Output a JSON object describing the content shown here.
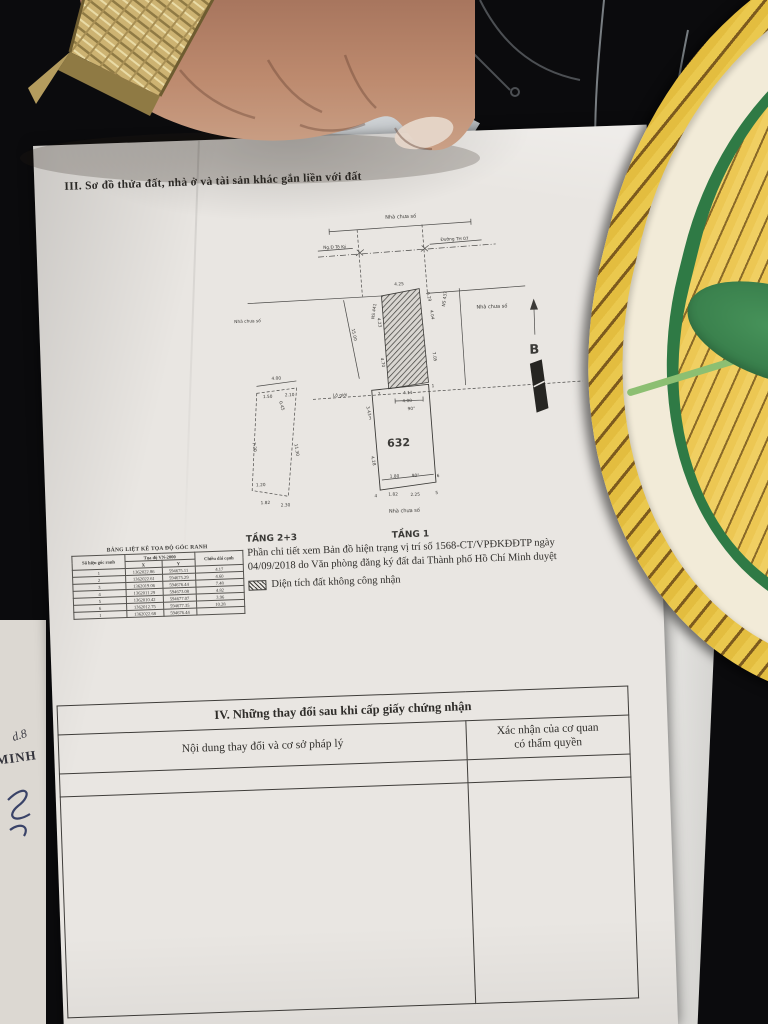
{
  "scene": {
    "background_color": "#0b0b0d",
    "paper_color": "#e9e6e2",
    "basket_yellow": "#eac84e",
    "basket_stripe": "#7c5a1e",
    "basket_rim": "#f2ebd8",
    "leaf_green": "#3e8a50",
    "hand_skin": "#b9856a",
    "watch_gold": "#cdb372",
    "carpet_gray": "#9b9995"
  },
  "document": {
    "section3_heading": "III. Sơ đồ thửa đất, nhà ở và tài sản khác gắn liền với đất",
    "diagram": {
      "labels": {
        "house_top": "Nhà chưa số",
        "street_left": "Ng.Đ Tô Ký",
        "street_right": "Đường TH 07",
        "house_left": "Nhà chưa số",
        "house_right": "Nhà chưa số",
        "house_bottom": "Nhà chưa số",
        "lo_gioi": "Lộ giới",
        "ns_left": "NS 441",
        "ns_right": "NS 437",
        "d15": "15.00",
        "north": "B",
        "plot_number": "632",
        "floor1": "TẦNG 1",
        "floors23": "TẦNG 2+3"
      },
      "dims": {
        "t1": "4.25",
        "t2": "0.29",
        "l1": "4.23",
        "r1": "4.04",
        "l2": "4.70",
        "r2": "7.05",
        "b1": "4.11",
        "b2": "4.00",
        "ang": "90°",
        "v1": "1",
        "v2": "2",
        "v3": "3",
        "v4": "4",
        "v5": "5",
        "v6": "6",
        "pl1": "3.43",
        "pl2": "4.28",
        "pb1": "1.82",
        "pb2": "2.25",
        "pb3": "1.80",
        "pang": "90°"
      },
      "annex_dims": {
        "t": "4.00",
        "s1": "1.50",
        "s2": "0.45",
        "s3": "2.10",
        "l": "7.20",
        "r": "11.30",
        "b1": "1.82",
        "b2": "2.30",
        "b3": "1.20"
      }
    },
    "coords_table": {
      "title": "BẢNG LIỆT KÊ TỌA ĐỘ GÓC RANH",
      "col_corner": "Số hiệu góc ranh",
      "col_group": "Tọa độ VN-2000",
      "col_x": "X",
      "col_y": "Y",
      "col_len": "Chiều dài cạnh",
      "rows": [
        [
          "1",
          "1362022.86",
          "594675.11",
          "4.17"
        ],
        [
          "2",
          "1362022.61",
          "594675.29",
          "4.60"
        ],
        [
          "3",
          "1362019.06",
          "594676.44",
          "7.48"
        ],
        [
          "4",
          "1362011.29",
          "594673.08",
          "4.82"
        ],
        [
          "5",
          "1362010.42",
          "594677.07",
          "3.96"
        ],
        [
          "6",
          "1362012.75",
          "594677.35",
          "10.28"
        ],
        [
          "1",
          "1362022.68",
          "594676.44",
          ""
        ]
      ]
    },
    "note": {
      "text": "Phần chi tiết xem Bản đồ hiện trạng vị trí số 1568-CT/VPĐKĐĐTP ngày 04/09/2018 do Văn phòng đăng ký đất đai Thành phố Hồ Chí Minh duyệt",
      "legend": "Diện tích đất không công nhận"
    },
    "section4": {
      "heading": "IV. Những thay đổi sau khi cấp giấy chứng nhận",
      "col_left": "Nội dung thay đổi và cơ sở pháp lý",
      "col_right_line1": "Xác nhận của cơ quan",
      "col_right_line2": "có thẩm quyền"
    },
    "under_page": {
      "text1": "d.8",
      "text2": "MINH"
    }
  }
}
